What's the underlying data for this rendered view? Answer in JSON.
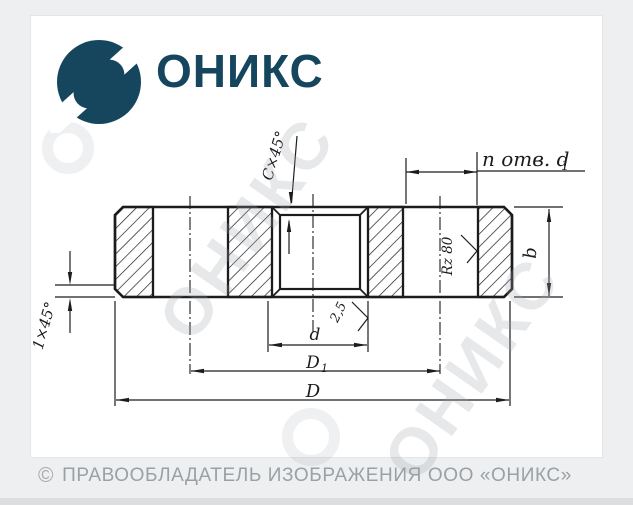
{
  "page": {
    "background_color": "#edeff0",
    "panel_color": "#ffffff"
  },
  "brand": {
    "name": "ОНИКС",
    "color": "#16455e"
  },
  "watermark": {
    "text": "ОНИКС"
  },
  "drawing": {
    "subject": "flange cross-section",
    "line_color": "#1c1c1e",
    "labels": {
      "chamfer_top": "C×45°",
      "holes": "n отв. d",
      "holes_sub": "1",
      "thickness": "b",
      "roughness_bolt_hole": "Rz 80",
      "roughness_bore": "2,5",
      "chamfer_left": "1×45°",
      "bore_diameter": "d",
      "bolt_circle_diameter": "D",
      "bolt_circle_sub": "1",
      "outer_diameter": "D"
    }
  },
  "footer": {
    "copyright_symbol": "©",
    "copyright_text": "ПРАВООБЛАДАТЕЛЬ ИЗОБРАЖЕНИЯ ООО «ОНИКС»"
  }
}
